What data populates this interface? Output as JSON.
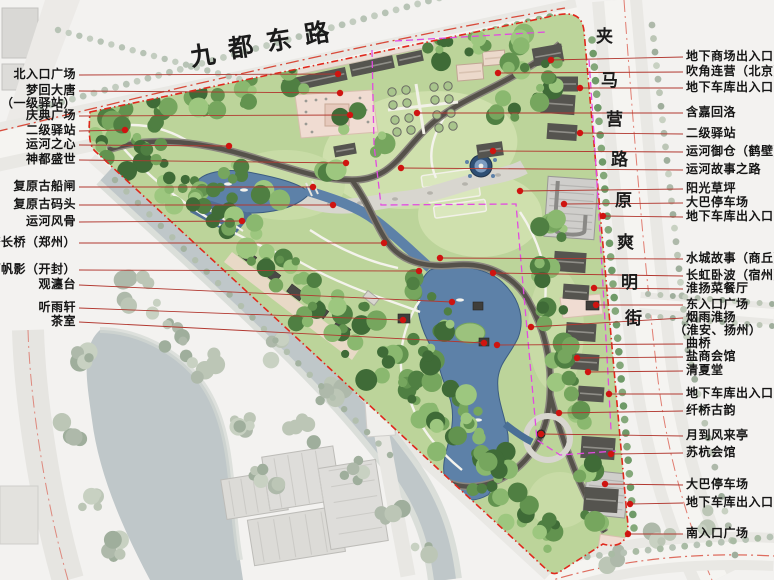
{
  "map": {
    "title": "运河公园总平面图",
    "roads": {
      "top": "九都东路",
      "right_upper": "夹马营路",
      "right_lower": "原爽明街"
    },
    "labels_left": [
      {
        "lines": [
          "北入口广场"
        ],
        "y": 75,
        "dot": [
          338,
          74
        ]
      },
      {
        "lines": [
          "梦回大唐",
          "（一级驿站）"
        ],
        "y": 91,
        "dot": [
          340,
          93
        ]
      },
      {
        "lines": [
          "庆典广场"
        ],
        "y": 116,
        "dot": [
          350,
          115
        ]
      },
      {
        "lines": [
          "二级驿站"
        ],
        "y": 131,
        "dot": [
          125,
          130
        ]
      },
      {
        "lines": [
          "运河之心"
        ],
        "y": 145,
        "dot": [
          229,
          146
        ]
      },
      {
        "lines": [
          "神都盛世"
        ],
        "y": 160,
        "dot": [
          346,
          163
        ]
      },
      {
        "lines": [
          "复原古船闸"
        ],
        "y": 187,
        "dot": [
          313,
          187
        ]
      },
      {
        "lines": [
          "复原古码头"
        ],
        "y": 205,
        "dot": [
          333,
          205
        ]
      },
      {
        "lines": [
          "运河风骨"
        ],
        "y": 222,
        "dot": [
          242,
          221
        ]
      },
      {
        "lines": [
          "惠济长桥（郑州）"
        ],
        "y": 243,
        "dot": [
          384,
          243
        ]
      },
      {
        "lines": [
          "汴河帆影（开封）"
        ],
        "y": 270,
        "dot": [
          419,
          271
        ]
      },
      {
        "lines": [
          "观瀍台"
        ],
        "y": 285,
        "dot": [
          452,
          302
        ]
      },
      {
        "lines": [
          "听雨轩"
        ],
        "y": 308,
        "dot": [
          403,
          320
        ]
      },
      {
        "lines": [
          "茶室"
        ],
        "y": 322,
        "dot": [
          484,
          343
        ]
      }
    ],
    "labels_right": [
      {
        "lines": [
          "地下商场出入口"
        ],
        "y": 57,
        "dot": [
          551,
          60
        ]
      },
      {
        "lines": [
          "吹角连营（北京）"
        ],
        "y": 72,
        "dot": [
          498,
          73
        ]
      },
      {
        "lines": [
          "地下车库出入口"
        ],
        "y": 88,
        "dot": [
          580,
          88
        ]
      },
      {
        "lines": [
          "含嘉回洛"
        ],
        "y": 113,
        "dot": [
          417,
          113
        ]
      },
      {
        "lines": [
          "二级驿站"
        ],
        "y": 134,
        "dot": [
          580,
          133
        ]
      },
      {
        "lines": [
          "运河御仓（鹤壁）"
        ],
        "y": 152,
        "dot": [
          493,
          151
        ]
      },
      {
        "lines": [
          "运河故事之路"
        ],
        "y": 170,
        "dot": [
          401,
          168
        ]
      },
      {
        "lines": [
          "阳光草坪"
        ],
        "y": 189,
        "dot": [
          520,
          191
        ]
      },
      {
        "lines": [
          "大巴停车场"
        ],
        "y": 203,
        "dot": [
          564,
          204
        ]
      },
      {
        "lines": [
          "地下车库出入口"
        ],
        "y": 217,
        "dot": [
          603,
          216
        ]
      },
      {
        "lines": [
          "水城故事（商丘）"
        ],
        "y": 259,
        "dot": [
          440,
          258
        ]
      },
      {
        "lines": [
          "长虹卧波（宿州）"
        ],
        "y": 276,
        "dot": [
          493,
          273
        ]
      },
      {
        "lines": [
          "淮扬菜餐厅"
        ],
        "y": 289,
        "dot": [
          594,
          288
        ]
      },
      {
        "lines": [
          "东入口广场"
        ],
        "y": 305,
        "dot": [
          596,
          305
        ]
      },
      {
        "lines": [
          "烟雨淮扬",
          "（淮安、扬州）"
        ],
        "y": 318,
        "dot": [
          531,
          327
        ]
      },
      {
        "lines": [
          "曲桥"
        ],
        "y": 344,
        "dot": [
          497,
          345
        ]
      },
      {
        "lines": [
          "盐商会馆"
        ],
        "y": 357,
        "dot": [
          577,
          358
        ]
      },
      {
        "lines": [
          "清夏堂"
        ],
        "y": 371,
        "dot": [
          588,
          372
        ]
      },
      {
        "lines": [
          "地下车库出入口"
        ],
        "y": 394,
        "dot": [
          609,
          394
        ]
      },
      {
        "lines": [
          "纤桥古韵"
        ],
        "y": 411,
        "dot": [
          559,
          413
        ]
      },
      {
        "lines": [
          "月到风来亭"
        ],
        "y": 436,
        "dot": [
          541,
          434
        ]
      },
      {
        "lines": [
          "苏杭会馆"
        ],
        "y": 453,
        "dot": [
          611,
          454
        ]
      },
      {
        "lines": [
          "大巴停车场"
        ],
        "y": 485,
        "dot": [
          605,
          484
        ]
      },
      {
        "lines": [
          "地下车库出入口"
        ],
        "y": 503,
        "dot": [
          630,
          504
        ]
      },
      {
        "lines": [
          "南入口广场"
        ],
        "y": 534,
        "dot": [
          628,
          534
        ]
      }
    ],
    "colors": {
      "boundary_red": "#e0281c",
      "leader_red": "#b23830",
      "poi_dot": "#cf1410",
      "magenta_dash": "#e24ae0",
      "water": "#5d81a8",
      "park_green": "#bcd49a"
    }
  }
}
